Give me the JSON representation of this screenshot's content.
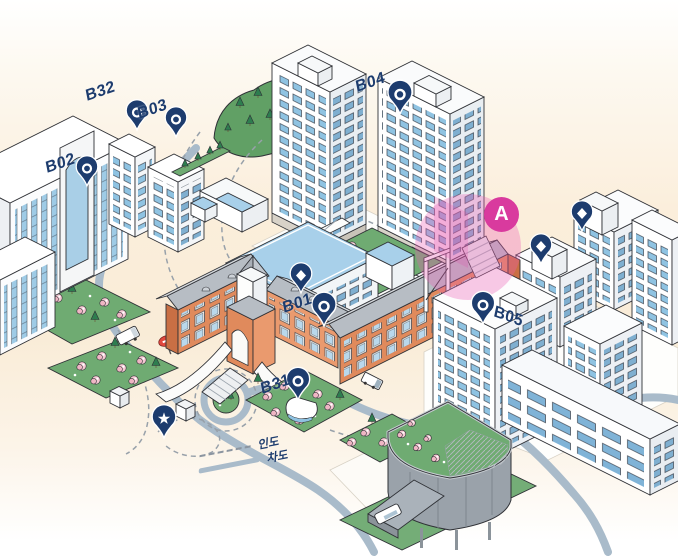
{
  "map": {
    "buildings": {
      "b01": {
        "label": "B01"
      },
      "b02": {
        "label": "B02"
      },
      "b03": {
        "label": "B03"
      },
      "b04": {
        "label": "B04"
      },
      "b05": {
        "label": "B05"
      },
      "b31": {
        "label": "B31"
      },
      "b32": {
        "label": "B32"
      }
    },
    "area_marker": {
      "label": "A"
    },
    "pins": {
      "labeled_icon": "ring-pin",
      "unlabeled_icons": [
        "diamond-pin",
        "diamond-pin",
        "diamond-pin"
      ],
      "special_icon": "star-pin"
    },
    "legend": {
      "items": [
        {
          "swatch": "dashed-line",
          "label": "인도"
        },
        {
          "swatch": "solid-line",
          "label": "차도"
        }
      ]
    },
    "colors": {
      "pin_navy": "#1d3c6e",
      "area_magenta": "#d93a9e",
      "area_glow": "#ee5fb5",
      "road": "#a9bbca",
      "path_dash": "#98a1aa",
      "garden": "#6fab72",
      "hill": "#61a065",
      "pine": "#2e7d4f",
      "blossom": "#f5c9d3",
      "brick": "#e08a5c",
      "brick_light": "#ea9a6e",
      "brick_dark": "#c96f44",
      "roof_gray": "#b7bdc4",
      "roof_light": "#d8dce0",
      "window_blue": "#8fc3e2",
      "glass_deep": "#7fb3d7",
      "modern_blue": "#a8d0ea",
      "drum_gray": "#9aa2aa",
      "outline": "#2f3136",
      "background_cream": "#fbeeda"
    }
  }
}
